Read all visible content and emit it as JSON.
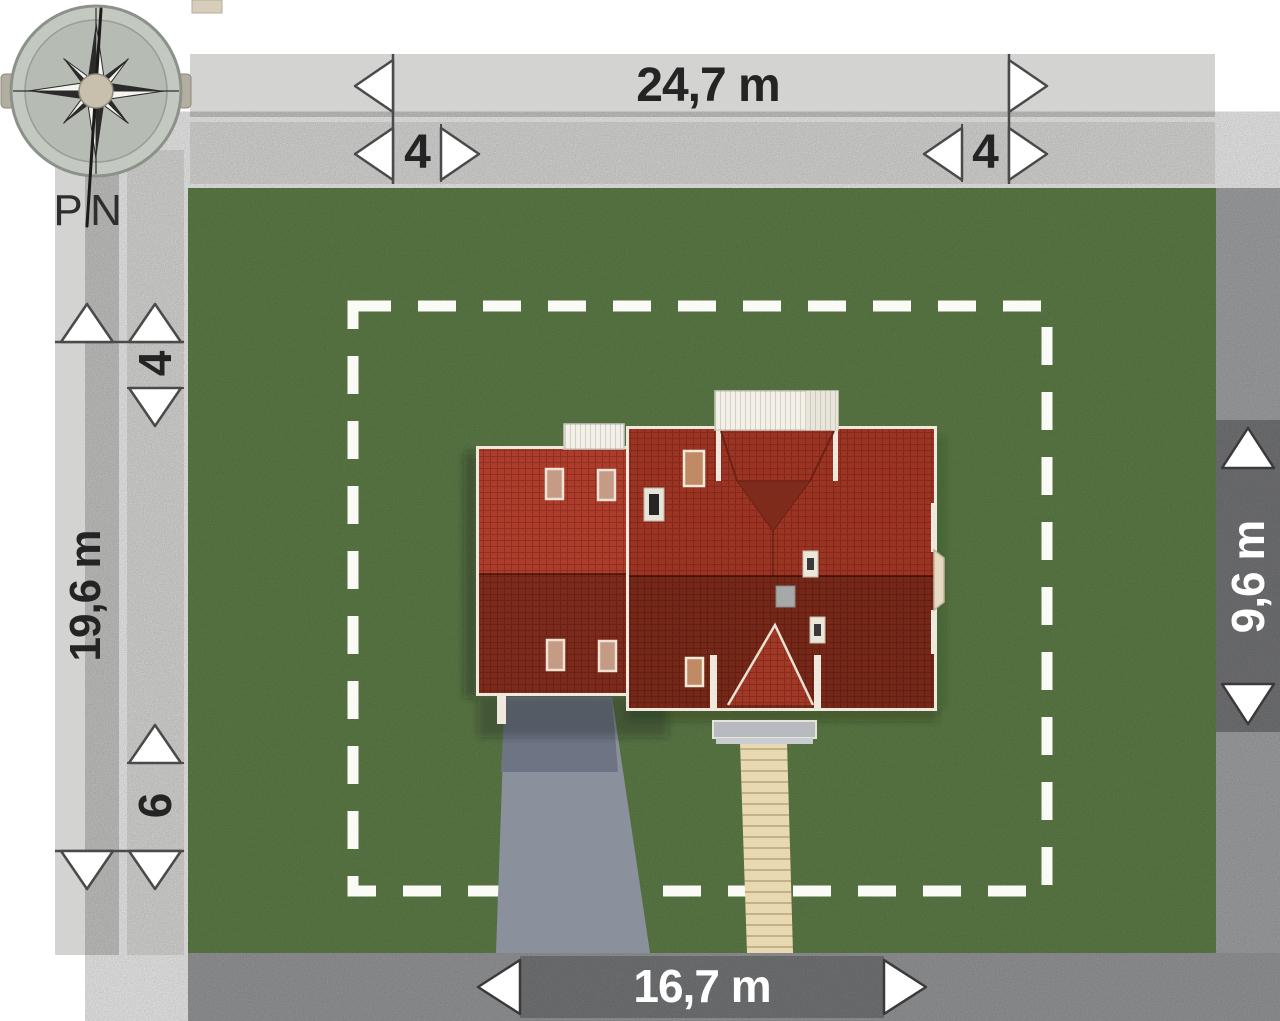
{
  "compass": {
    "west_label": "P",
    "north_label": "N"
  },
  "dimensions": {
    "plot_width": "24,7 m",
    "top_setback_left": "4",
    "top_setback_right": "4",
    "plot_depth": "19,6 m",
    "left_setback_top": "4",
    "left_setback_bottom": "6",
    "house_depth": "9,6 m",
    "house_width": "16,7 m"
  },
  "colors": {
    "grass": "#66884e",
    "roof_light_wing": "#ad3c2a",
    "roof_light_main": "#9c3423",
    "roof_dark": "#752818",
    "bar_primary": "#d3d4d2",
    "bar_secondary": "#e9eae7",
    "strip_bottom": "#a2a3a5",
    "strip_right": "#aeafb1",
    "dim_segment": "#7d7e80",
    "dashed_boundary": "#fafaf6",
    "driveway": "#8a919d",
    "walkway": "#e9d9b2",
    "canopy": "#f3f0e7"
  }
}
